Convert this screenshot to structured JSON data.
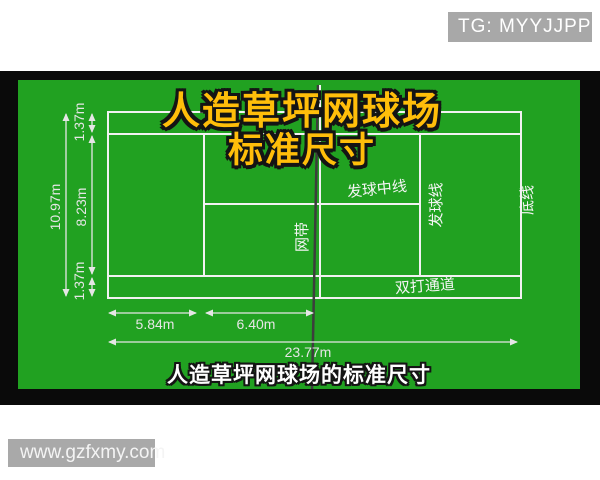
{
  "colors": {
    "court_green": "#21a121",
    "frame_black": "#0a0a0a",
    "badge_gray": "#a8a8a8",
    "title_gold": "#ffbe0a",
    "court_line_white": "#f2f2f2",
    "net_dark": "#3d3d3d"
  },
  "overlay": {
    "tg_badge": "TG: MYYJJPP",
    "watermark": "www.gzfxmy.com"
  },
  "title": {
    "line1": "人造草坪网球场",
    "line2": "标准尺寸"
  },
  "caption": "人造草坪网球场的标准尺寸",
  "diagram": {
    "labels": {
      "net_band": "网带",
      "center_service_line": "发球中线",
      "service_line": "发球线",
      "baseline": "底线",
      "doubles_alley": "双打通道"
    },
    "dimensions": {
      "total_width": "10.97m",
      "singles_width": "8.23m",
      "alley_width_top": "1.37m",
      "alley_width_bottom": "1.37m",
      "baseline_to_service_line": "5.84m",
      "service_line_to_net": "6.40m",
      "total_length": "23.77m"
    }
  }
}
